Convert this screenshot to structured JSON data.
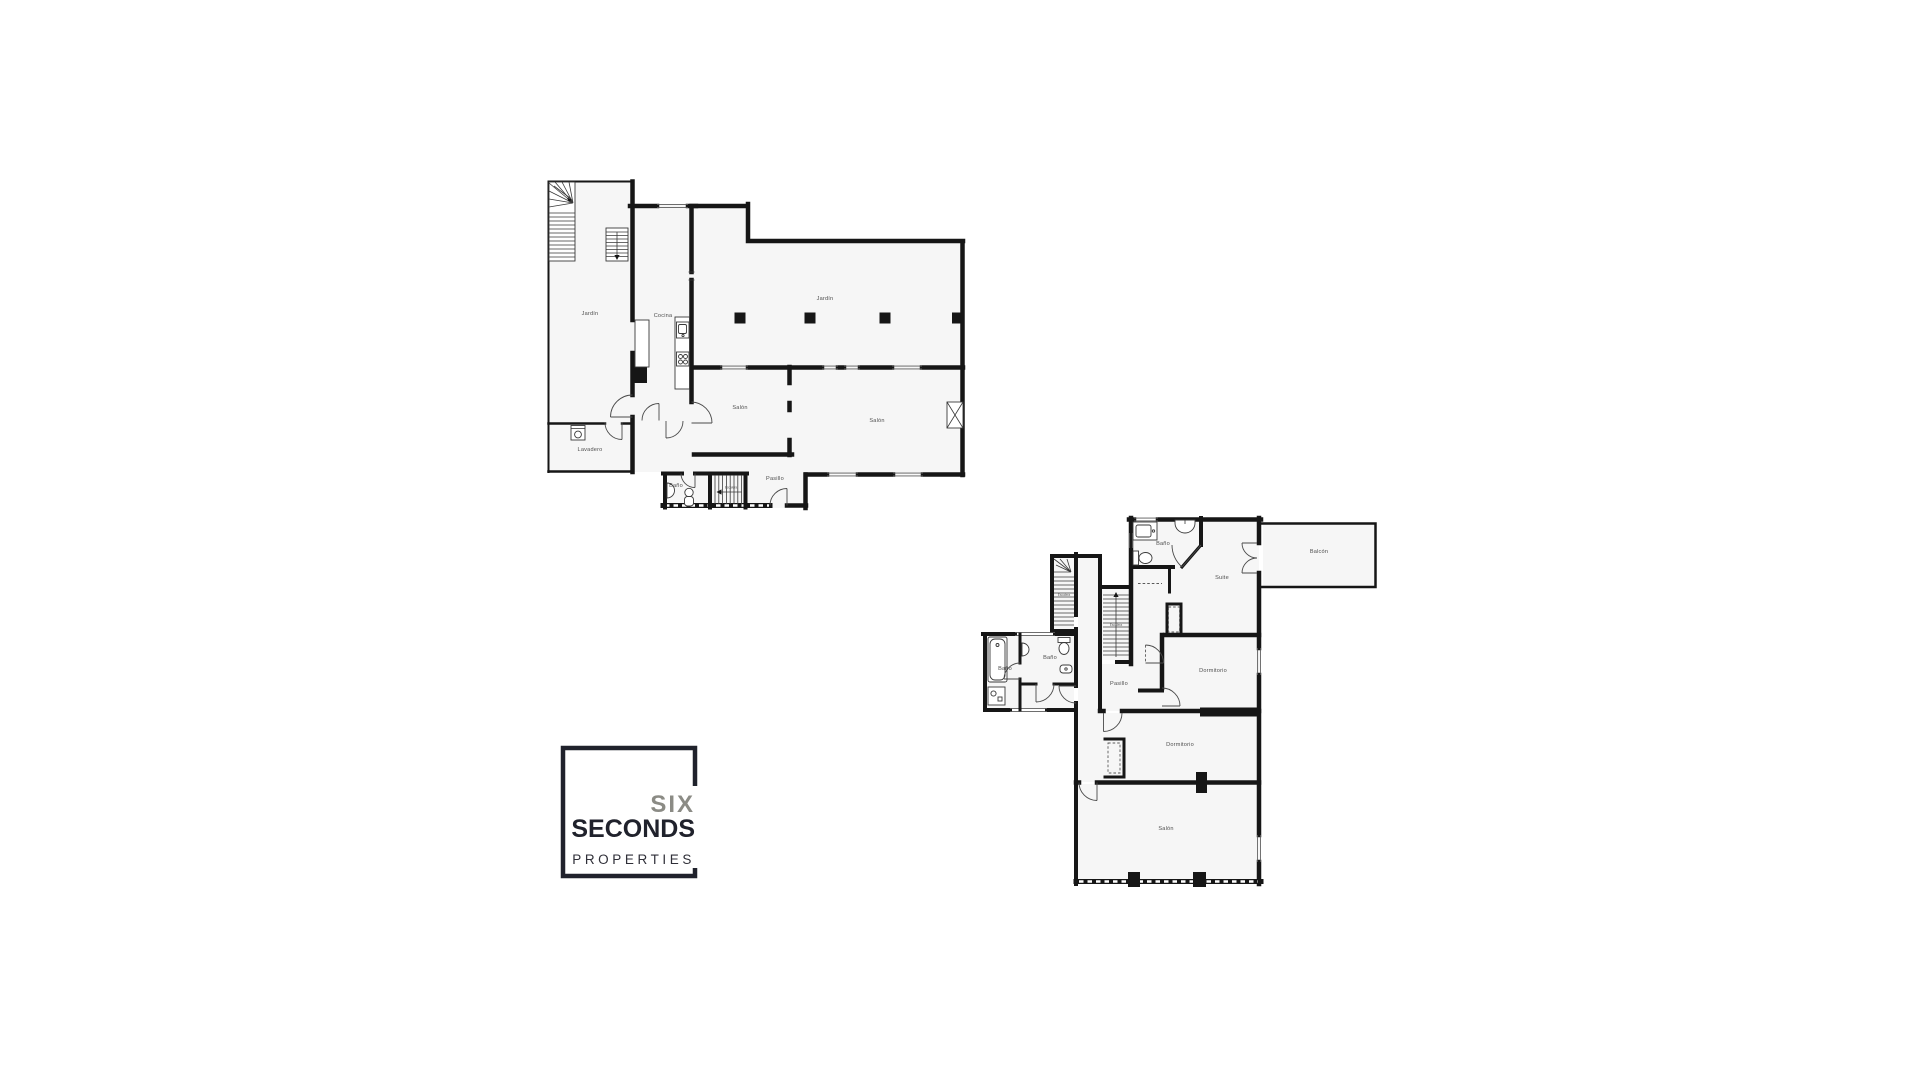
{
  "page": {
    "background": "#ffffff"
  },
  "colors": {
    "wall": "#161616",
    "room_fill": "#f6f6f6",
    "label": "#4f4f4f",
    "logo_frame": "#20222c",
    "logo_six": "#8b8b85",
    "logo_seconds": "#20222c",
    "logo_properties": "#2f2f38"
  },
  "floor_plans": [
    {
      "id": "ground-floor",
      "rooms": {
        "jardin_left": "Jardín",
        "cocina": "Cocina",
        "jardin_top": "Jardín",
        "salon_mid": "Salón",
        "salon_right": "Salón",
        "lavadero": "Lavadero",
        "pasillo": "Pasillo",
        "bano": "Baño",
        "escalera": "Escalera"
      }
    },
    {
      "id": "upper-floor",
      "rooms": {
        "bano_top": "Baño",
        "suite": "Suite",
        "balcon": "Balcón",
        "escalera_left": "Escalera",
        "escalera_right": "Escalera",
        "bano_left": "Baño",
        "bano_mid": "Baño",
        "pasillo": "Pasillo",
        "dormitorio_top": "Dormitorio",
        "dormitorio_bottom": "Dormitorio",
        "salon": "Salón"
      }
    }
  ],
  "logo": {
    "line1": "SIX",
    "line2": "SECONDS",
    "line3": "PROPERTIES"
  }
}
